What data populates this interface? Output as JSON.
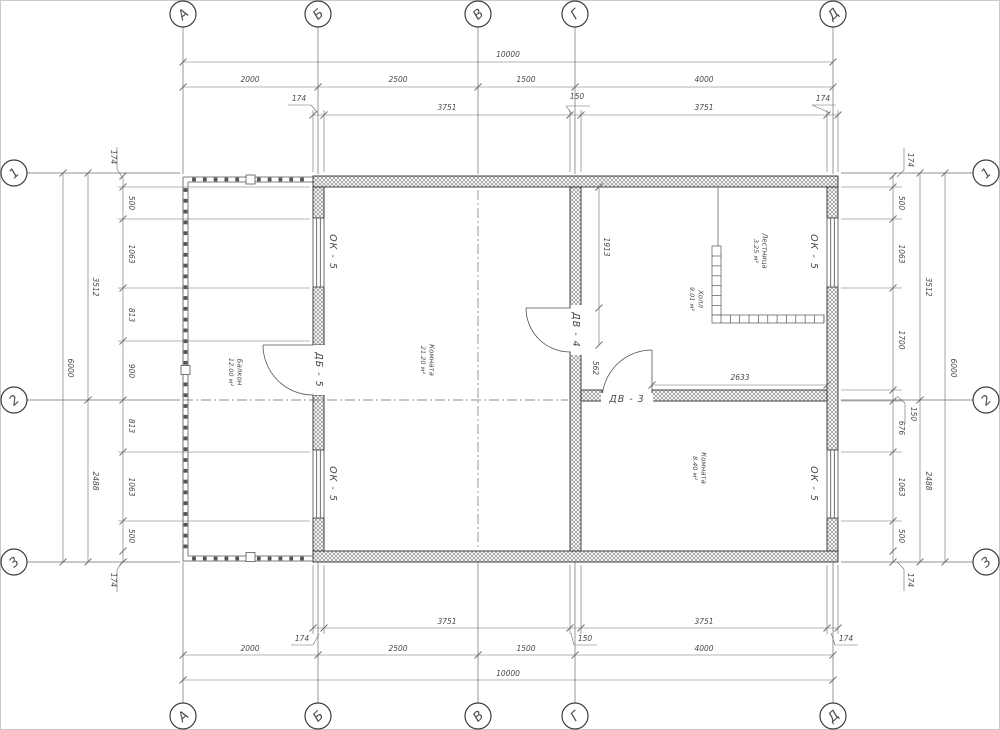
{
  "drawing": {
    "axes_top": [
      {
        "label": "А",
        "x": 183
      },
      {
        "label": "Б",
        "x": 318
      },
      {
        "label": "В",
        "x": 478
      },
      {
        "label": "Г",
        "x": 575
      },
      {
        "label": "Д",
        "x": 833
      }
    ],
    "axes_bottom": [
      {
        "label": "А",
        "x": 183
      },
      {
        "label": "Б",
        "x": 318
      },
      {
        "label": "В",
        "x": 478
      },
      {
        "label": "Г",
        "x": 575
      },
      {
        "label": "Д",
        "x": 833
      }
    ],
    "axes_left": [
      {
        "label": "1",
        "y": 173
      },
      {
        "label": "2",
        "y": 400
      },
      {
        "label": "3",
        "y": 562
      }
    ],
    "axes_right": [
      {
        "label": "1",
        "y": 173
      },
      {
        "label": "2",
        "y": 400
      },
      {
        "label": "3",
        "y": 562
      }
    ],
    "dims_top": [
      {
        "t": "10000",
        "x": 508,
        "y": 57
      },
      {
        "t": "2000",
        "x": 250,
        "y": 82
      },
      {
        "t": "2500",
        "x": 398,
        "y": 82
      },
      {
        "t": "1500",
        "x": 526,
        "y": 82
      },
      {
        "t": "4000",
        "x": 704,
        "y": 82
      },
      {
        "t": "174",
        "x": 299,
        "y": 101
      },
      {
        "t": "3751",
        "x": 447,
        "y": 110
      },
      {
        "t": "150",
        "x": 577,
        "y": 99
      },
      {
        "t": "3751",
        "x": 704,
        "y": 110
      },
      {
        "t": "174",
        "x": 823,
        "y": 101
      }
    ],
    "dims_bottom": [
      {
        "t": "3751",
        "x": 447,
        "y": 624
      },
      {
        "t": "3751",
        "x": 704,
        "y": 624
      },
      {
        "t": "174",
        "x": 302,
        "y": 641
      },
      {
        "t": "150",
        "x": 585,
        "y": 641
      },
      {
        "t": "174",
        "x": 846,
        "y": 641
      },
      {
        "t": "2000",
        "x": 250,
        "y": 651
      },
      {
        "t": "2500",
        "x": 398,
        "y": 651
      },
      {
        "t": "1500",
        "x": 526,
        "y": 651
      },
      {
        "t": "4000",
        "x": 704,
        "y": 651
      },
      {
        "t": "10000",
        "x": 508,
        "y": 676
      }
    ],
    "dims_left": [
      {
        "t": "6000",
        "x": 68,
        "y": 368,
        "v": 1
      },
      {
        "t": "3512",
        "x": 93,
        "y": 287,
        "v": 1
      },
      {
        "t": "2488",
        "x": 93,
        "y": 481,
        "v": 1
      },
      {
        "t": "174",
        "x": 111,
        "y": 157,
        "v": 1
      },
      {
        "t": "500",
        "x": 129,
        "y": 203,
        "v": 1
      },
      {
        "t": "1063",
        "x": 129,
        "y": 254,
        "v": 1
      },
      {
        "t": "813",
        "x": 129,
        "y": 315,
        "v": 1
      },
      {
        "t": "900",
        "x": 129,
        "y": 371,
        "v": 1
      },
      {
        "t": "813",
        "x": 129,
        "y": 426,
        "v": 1
      },
      {
        "t": "1063",
        "x": 129,
        "y": 487,
        "v": 1
      },
      {
        "t": "500",
        "x": 129,
        "y": 536,
        "v": 1
      },
      {
        "t": "174",
        "x": 111,
        "y": 580,
        "v": 1
      }
    ],
    "dims_right": [
      {
        "t": "6000",
        "x": 951,
        "y": 368,
        "v": 1
      },
      {
        "t": "3512",
        "x": 926,
        "y": 287,
        "v": 1
      },
      {
        "t": "2488",
        "x": 926,
        "y": 481,
        "v": 1
      },
      {
        "t": "174",
        "x": 908,
        "y": 160,
        "v": 1
      },
      {
        "t": "500",
        "x": 899,
        "y": 203,
        "v": 1
      },
      {
        "t": "1063",
        "x": 899,
        "y": 254,
        "v": 1
      },
      {
        "t": "1700",
        "x": 899,
        "y": 340,
        "v": 1
      },
      {
        "t": "150",
        "x": 911,
        "y": 414,
        "v": 1
      },
      {
        "t": "676",
        "x": 899,
        "y": 428,
        "v": 1
      },
      {
        "t": "1063",
        "x": 899,
        "y": 487,
        "v": 1
      },
      {
        "t": "500",
        "x": 899,
        "y": 536,
        "v": 1
      },
      {
        "t": "174",
        "x": 908,
        "y": 580,
        "v": 1
      }
    ],
    "dims_interior": [
      {
        "t": "1913",
        "x": 604,
        "y": 247,
        "v": 1
      },
      {
        "t": "562",
        "x": 593,
        "y": 368,
        "v": 1
      },
      {
        "t": "2633",
        "x": 740,
        "y": 380
      }
    ],
    "rooms": [
      {
        "name": "Балкон",
        "area": "12.00 м²",
        "x": 236,
        "y": 372
      },
      {
        "name": "Комната",
        "area": "21.20 м²",
        "x": 428,
        "y": 360
      },
      {
        "name": "Холл",
        "area": "9.01 м²",
        "x": 697,
        "y": 299
      },
      {
        "name": "Лестница",
        "area": "3.25 м²",
        "x": 761,
        "y": 251
      },
      {
        "name": "Комната",
        "area": "8.40 м²",
        "x": 700,
        "y": 468
      }
    ],
    "opening_labels": [
      {
        "t": "ОК - 5",
        "x": 333,
        "y": 252,
        "o": "v",
        "kind": "window"
      },
      {
        "t": "ОК - 5",
        "x": 333,
        "y": 484,
        "o": "v",
        "kind": "window"
      },
      {
        "t": "ОК - 5",
        "x": 814,
        "y": 252,
        "o": "v",
        "kind": "window"
      },
      {
        "t": "ОК - 5",
        "x": 814,
        "y": 484,
        "o": "v",
        "kind": "window"
      },
      {
        "t": "ДБ - 5",
        "x": 319,
        "y": 370,
        "o": "v",
        "bg": 1,
        "kind": "door"
      },
      {
        "t": "ДВ - 4",
        "x": 576,
        "y": 330,
        "o": "v",
        "bg": 1,
        "kind": "door"
      },
      {
        "t": "ДВ - 3",
        "x": 627,
        "y": 399,
        "o": "h",
        "bg": 1,
        "kind": "door"
      }
    ],
    "colors": {
      "line": "#4a4a4a",
      "thin": "#6b6b6b",
      "wall_edge": "#2f2f2f",
      "hatch": "#8f8f8f"
    }
  }
}
